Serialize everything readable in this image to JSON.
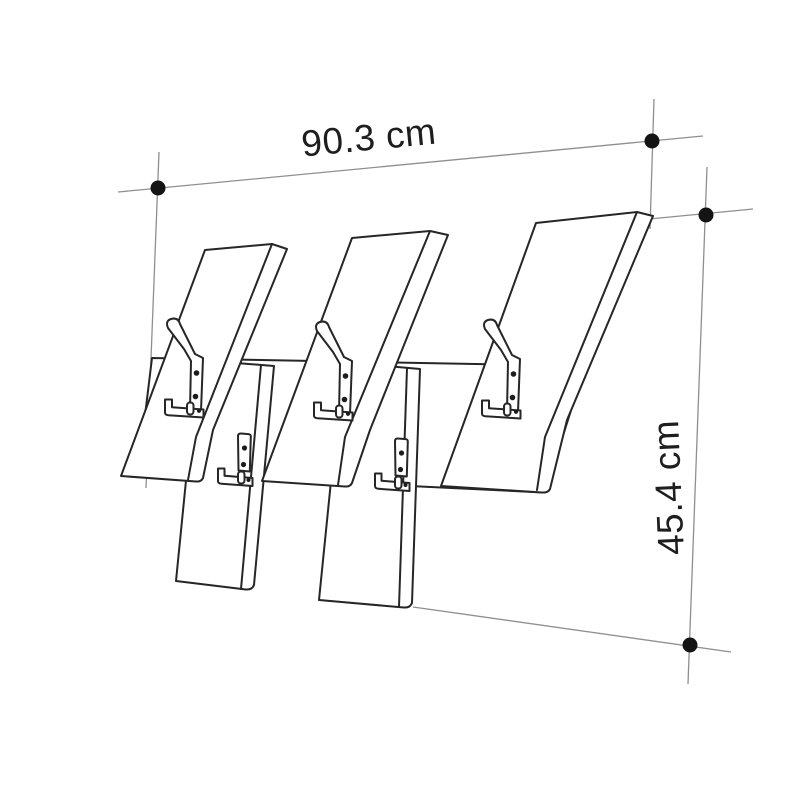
{
  "diagram": {
    "subject": "Wall-mounted coat rack dimension drawing",
    "width_label": "90.3 cm",
    "height_label": "45.4 cm"
  },
  "colors": {
    "background": "#ffffff",
    "line_art": "#262626",
    "dimension_line": "#8f8f8f",
    "marker_dot": "#141414",
    "label_text": "#1e1e1e"
  }
}
